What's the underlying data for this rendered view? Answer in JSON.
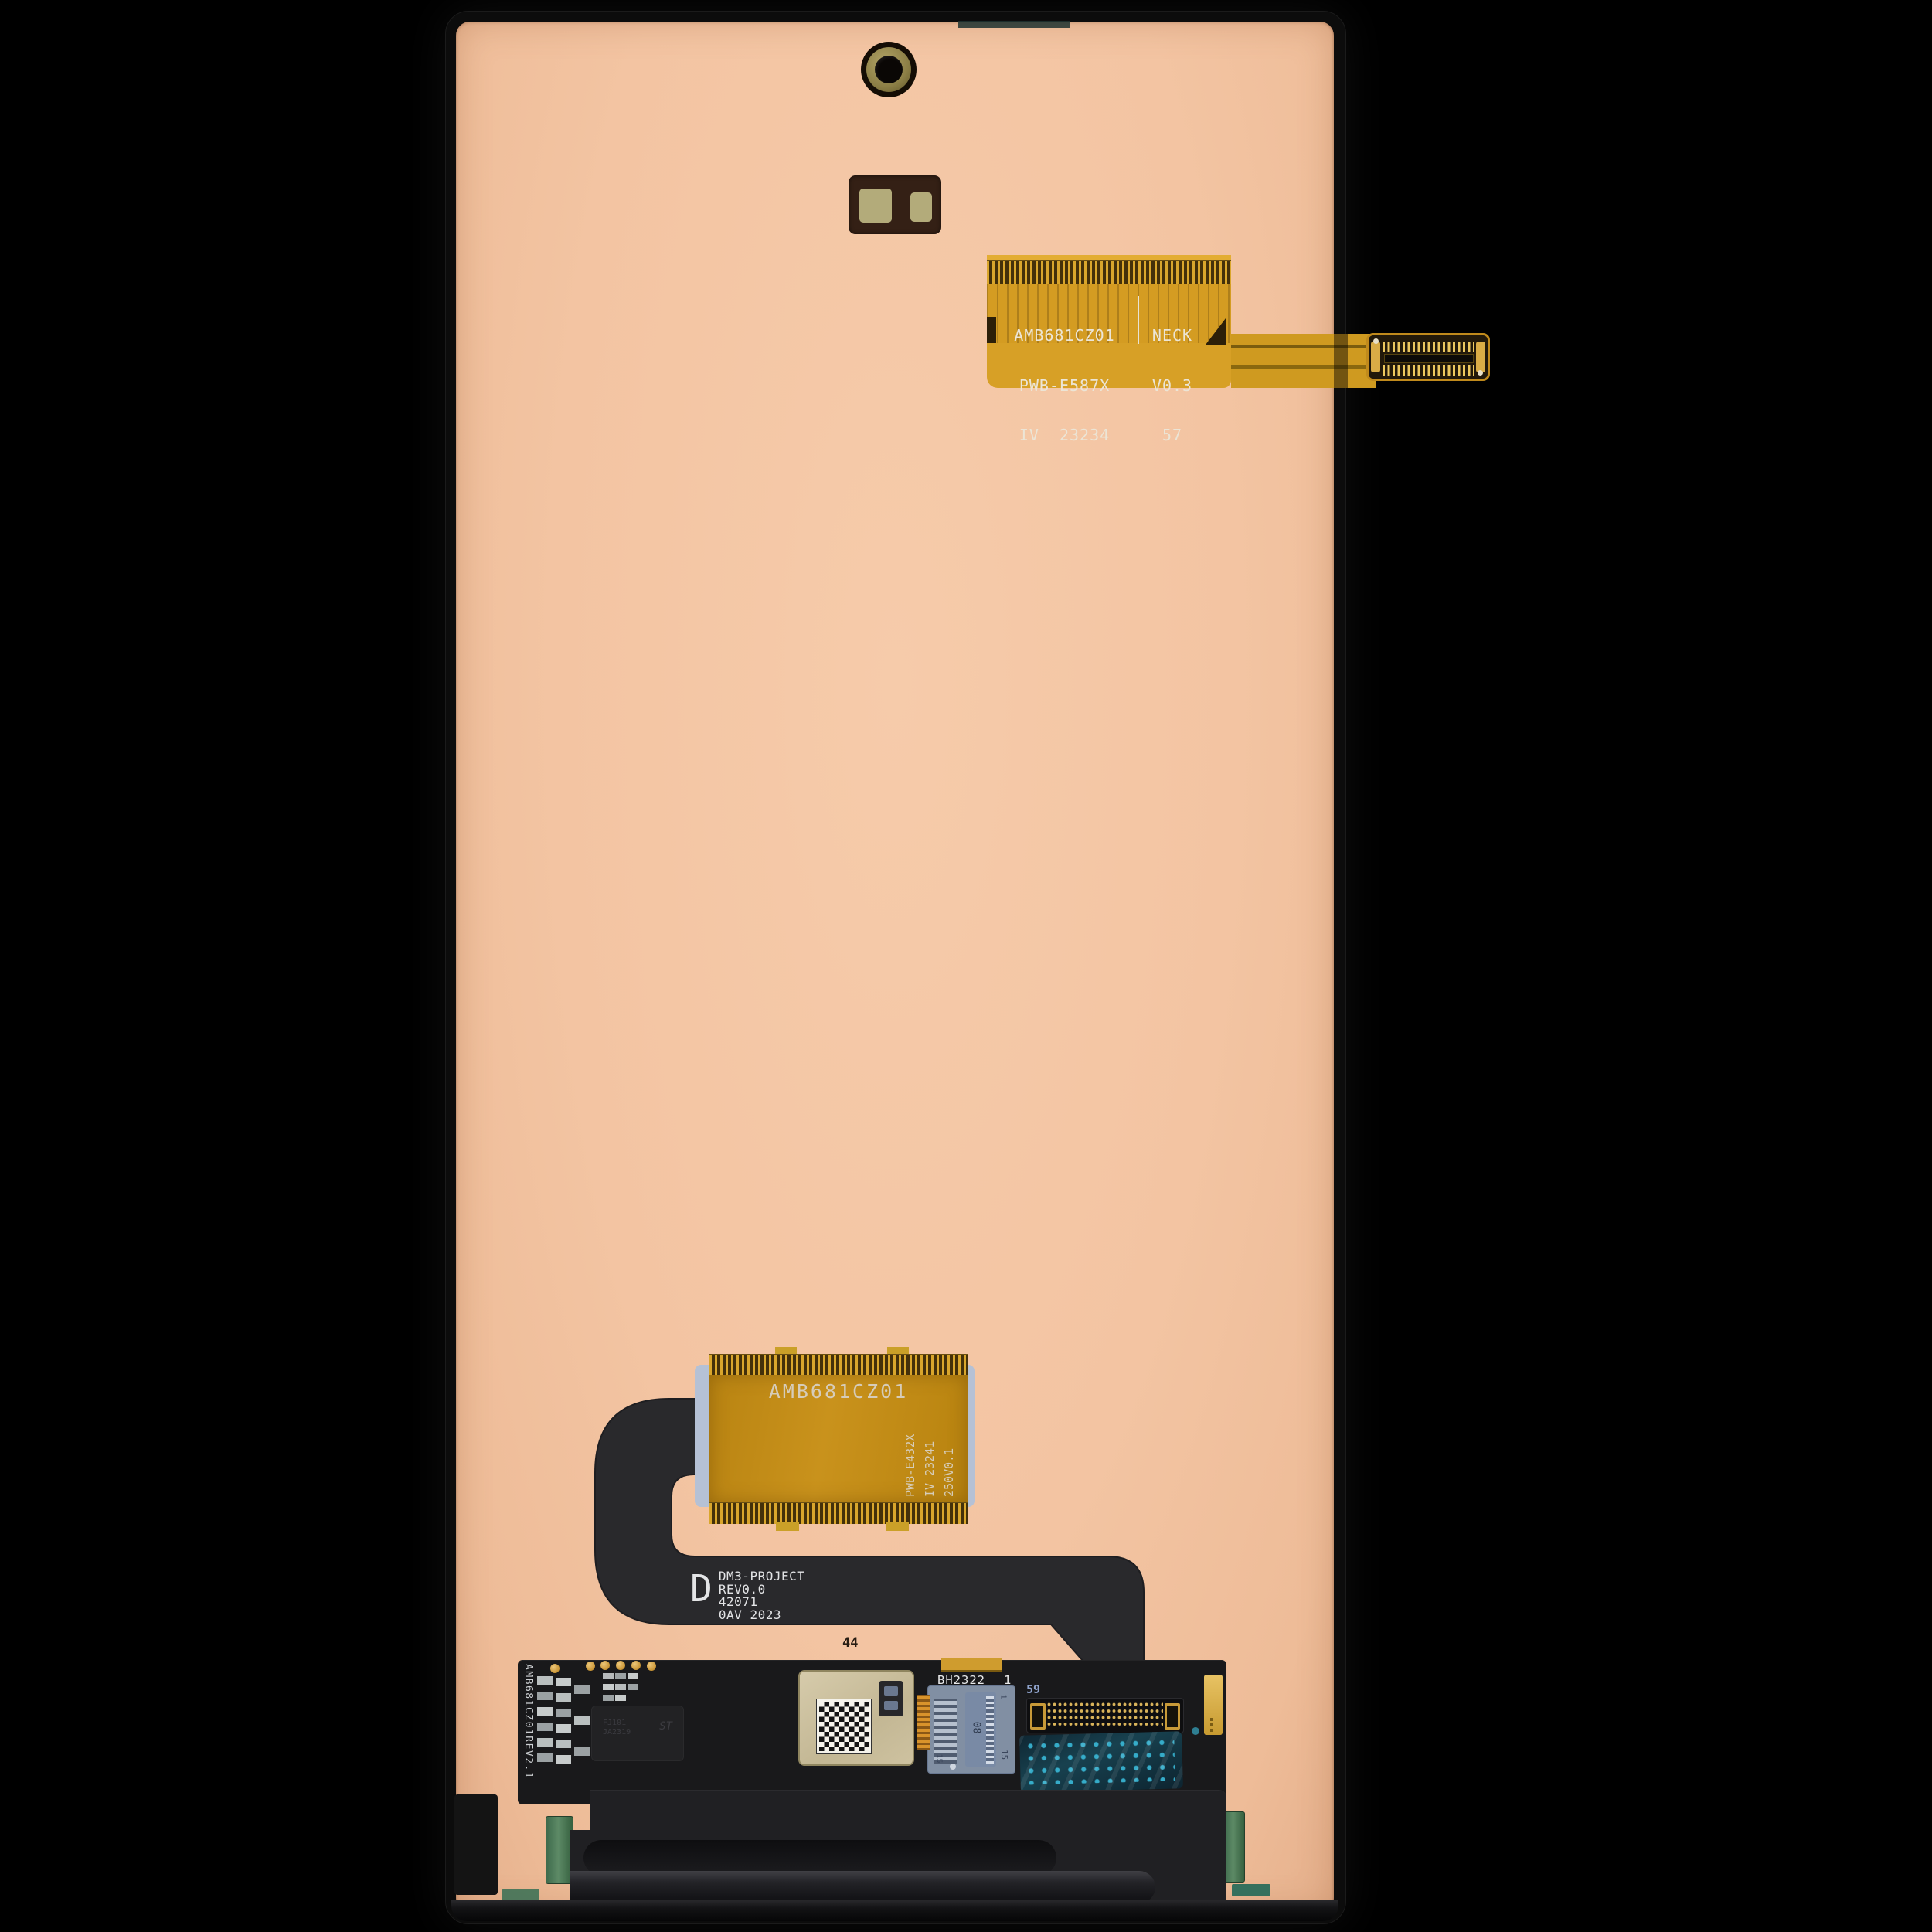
{
  "colors": {
    "background": "#000000",
    "panel_frame": "#0c0c0c",
    "panel_copper": "#f3c5a5",
    "flex_gold": "#d49c22",
    "flex_gold_deep": "#bb8514",
    "ribbon_black": "#29292c",
    "pcb_black": "#19191b",
    "text_on_flex": "#ece5d6",
    "text_on_ribbon": "#e3e4e6",
    "gold_pad": "#d3a139",
    "shield_beige": "#cfc3a2",
    "socket_translucent_blue": "#9badc6",
    "film_blue": "#18414f",
    "film_dots": "#39b9d8",
    "pcb_green": "#57805f",
    "camera_ring_olive": "#9c8f55"
  },
  "top_flex": {
    "col1": [
      "AMB681CZ01",
      "PWB-E587X",
      "IV  23234"
    ],
    "col2": [
      "NECK",
      "V0.3",
      "57"
    ]
  },
  "mid_flex": {
    "title": "AMB681CZ01",
    "side_lines": [
      "PWB-E432X",
      "IV 23241",
      "250V0.1"
    ]
  },
  "ribbon": {
    "d_mark": "D",
    "lines": [
      "DM3-PROJECT",
      "REV0.0",
      "42071",
      "0AV 2023"
    ],
    "pin_count": "44"
  },
  "pcb": {
    "edge_marking": "AMB681CZ01REV2.1",
    "connector_label": "BH2322",
    "connector_index": "1",
    "pin_label": "59",
    "ic_lines": [
      "FJ101",
      "JA2319"
    ],
    "st_logo": "ST",
    "socket_num_center": "08",
    "socket_num_right": "15",
    "socket_num_left": "15",
    "socket_num_top": "1"
  }
}
